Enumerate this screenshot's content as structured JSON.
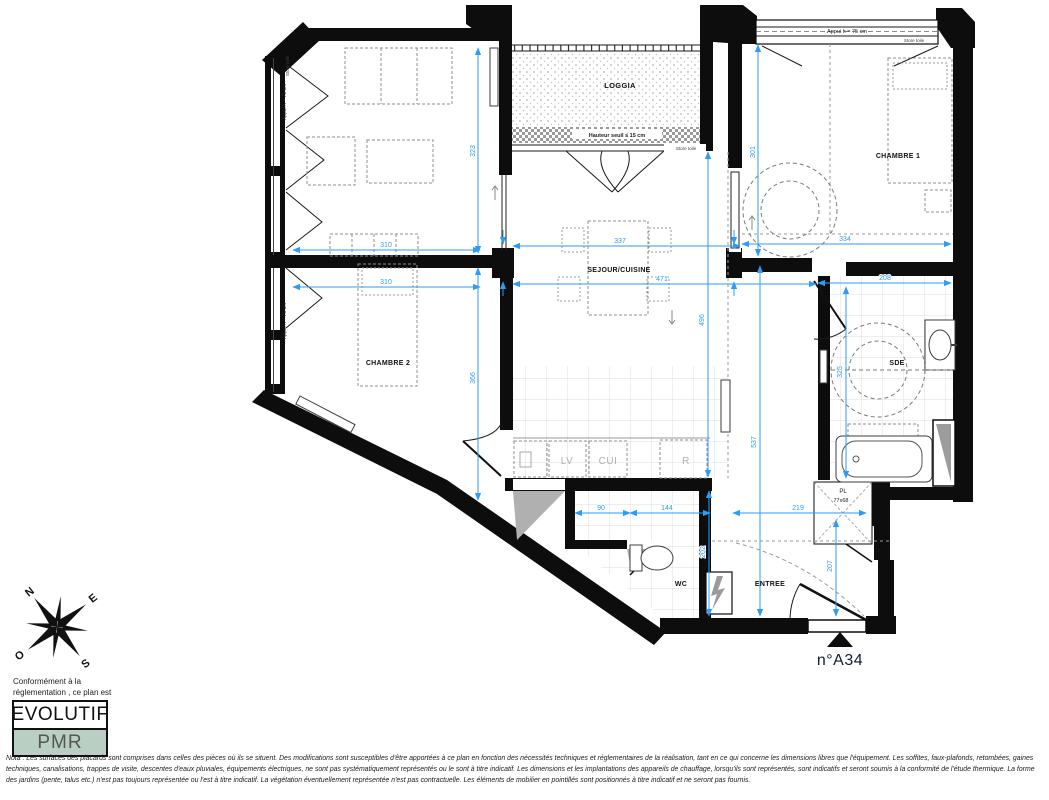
{
  "unit": {
    "number": "n°A34"
  },
  "rooms": {
    "loggia": "LOGGIA",
    "chambre1": "CHAMBRE 1",
    "chambre2": "CHAMBRE 2",
    "sejour": "SEJOUR/CUISINE",
    "sde": "SDE",
    "wc": "WC",
    "entree": "ENTREE",
    "placard": "PL",
    "placard_size": "77x68"
  },
  "kitchen": {
    "lv": "LV",
    "cui": "CUI",
    "r": "R"
  },
  "notes": {
    "appui": "Appui h = 75 cm",
    "store": "Store toile",
    "seuil": "Hauteur seuil ≤ 15 cm"
  },
  "dims": {
    "room1_w": "310",
    "room1_h": "323",
    "ch2_w": "310",
    "ch2_h": "366",
    "sej_w1": "337",
    "sej_w2": "471",
    "sej_h": "496",
    "ch1_w": "334",
    "ch1_h": "301",
    "sde_w": "208",
    "sde_h": "325",
    "hall_w1": "90",
    "hall_w2": "144",
    "hall_h": "202",
    "ent_w": "219",
    "ent_h": "207",
    "kit_h": "537"
  },
  "compass": {
    "n": "N",
    "e": "E",
    "s": "S",
    "o": "O"
  },
  "legend": {
    "line1": "Conformément à la",
    "line2": "réglementation , ce plan est",
    "evolutif": "EVOLUTIF",
    "pmr": "PMR"
  },
  "nota": {
    "text": "Nota : Les surfaces des placards sont comprises dans celles des pièces où ils se situent. Des modifications sont susceptibles d'être apportées à ce plan en fonction des nécessités techniques et réglementaires de la réalisation, tant en ce qui concerne les dimensions libres que l'équipement. Les soffites, faux-plafonds, retombées, gaines techniques, canalisations, trappes de visite, descentes d'eaux pluviales, équipements électriques, ne sont pas systématiquement représentés ou le sont à titre indicatif. Les dimensions et les implantations des appareils de chauffage, lorsqu'ils sont représentés, sont indicatifs et seront soumis à la conformité de l'étude thermique. La forme des jardins (pente, talus etc.) n'est pas toujours représentée ou l'est à titre indicatif. La végétation éventuellement représentée n'est pas contractuelle. Les éléments de mobilier en pointillés sont positionnés à titre indicatif et ne seront pas fournis."
  },
  "colors": {
    "dimension_blue": "#2E9BF5",
    "pmr_bg": "#B9CFC4",
    "wall": "#0d0d0d"
  }
}
